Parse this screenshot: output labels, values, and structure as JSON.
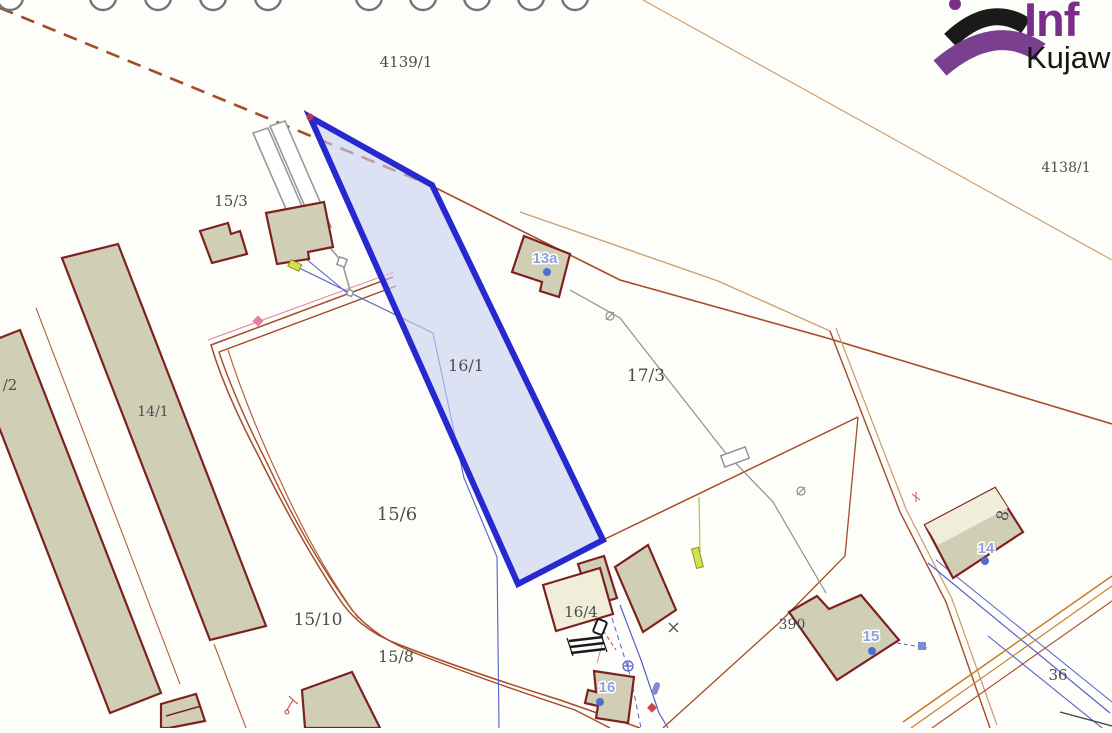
{
  "map": {
    "title": "cadastral-map",
    "highlight_parcel": "16/1",
    "colors": {
      "background": "#fdfdfa",
      "boundary_red": "#a64b28",
      "tan_line": "#cfa070",
      "gray_line": "#8f8f8f",
      "utility_blue": "#5560c8",
      "pink_line": "#e080a0",
      "orange_line": "#c8761e",
      "building_fill": "#d0cfb6",
      "building_pale_fill": "#f0edd9",
      "building_stroke": "#7d2020",
      "highlight_fill": "#c9d0f0",
      "highlight_stroke": "#2828cf",
      "label_color": "#4d4d4d",
      "building_label_color": "#8fa1da",
      "building_point_color": "#4f6fd0"
    },
    "parcel_labels": [
      {
        "id": "4139-1",
        "text": "4139/1",
        "x": 406,
        "y": 67,
        "size": 15
      },
      {
        "id": "4138-1",
        "text": "4138/1",
        "x": 1066,
        "y": 172,
        "size": 14
      },
      {
        "id": "15-3",
        "text": "15/3",
        "x": 231,
        "y": 206,
        "size": 15
      },
      {
        "id": "slash2",
        "text": "/2",
        "x": 10,
        "y": 390,
        "size": 15
      },
      {
        "id": "14-1",
        "text": "14/1",
        "x": 153,
        "y": 416,
        "size": 14
      },
      {
        "id": "16-1",
        "text": "16/1",
        "x": 466,
        "y": 371,
        "size": 16
      },
      {
        "id": "17-3",
        "text": "17/3",
        "x": 646,
        "y": 381,
        "size": 17
      },
      {
        "id": "15-6",
        "text": "15/6",
        "x": 397,
        "y": 520,
        "size": 18
      },
      {
        "id": "15-10",
        "text": "15/10",
        "x": 318,
        "y": 625,
        "size": 17
      },
      {
        "id": "15-8",
        "text": "15/8",
        "x": 396,
        "y": 662,
        "size": 16
      },
      {
        "id": "16-4",
        "text": "16/4",
        "x": 581,
        "y": 617,
        "size": 15
      },
      {
        "id": "390",
        "text": "390",
        "x": 792,
        "y": 629,
        "size": 14
      },
      {
        "id": "36",
        "text": "36",
        "x": 1058,
        "y": 680,
        "size": 15
      },
      {
        "id": "8",
        "text": "8",
        "x": 1008,
        "y": 517,
        "size": 16,
        "rotate": -75
      }
    ],
    "building_labels": [
      {
        "id": "13a",
        "text": "13a",
        "x": 545,
        "y": 263,
        "dx": 547,
        "dy": 272
      },
      {
        "id": "14",
        "text": "14",
        "x": 986,
        "y": 553,
        "dx": 985,
        "dy": 561
      },
      {
        "id": "15",
        "text": "15",
        "x": 871,
        "y": 641,
        "dx": 872,
        "dy": 651
      },
      {
        "id": "16",
        "text": "16",
        "x": 607,
        "y": 692,
        "dx": 600,
        "dy": 702
      }
    ]
  },
  "logo": {
    "line1": "Inf",
    "line2": "Kujaw",
    "accent_color": "#7b2d8b",
    "arc_color": "#1a1a1a"
  }
}
